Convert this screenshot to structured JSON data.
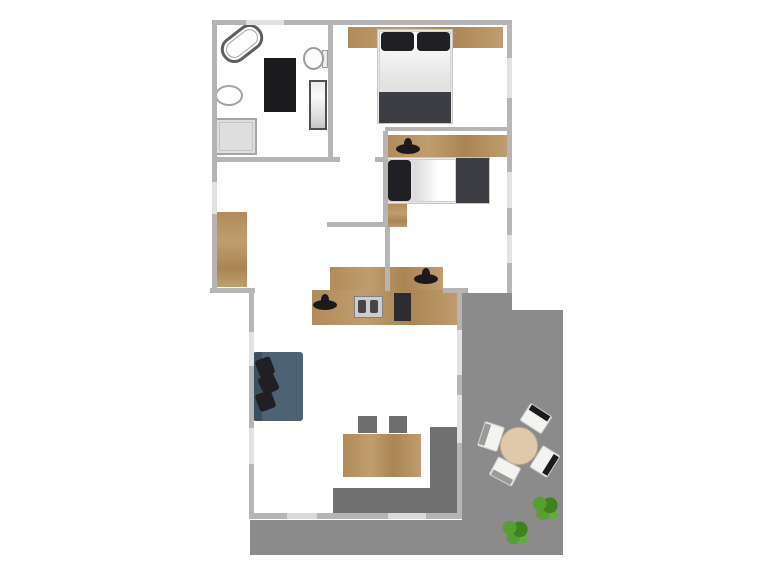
{
  "meta": {
    "canvas_width": 768,
    "canvas_height": 576
  },
  "palette": {
    "wall": "#b7b5b3",
    "window": "#e2e2e2",
    "door": "#d9d9d9",
    "wood-a": "#b18c5a",
    "wood-b": "#c09d6e",
    "wood-c": "#aa8553",
    "terrace": "#8b8b8b",
    "terrace-dark": "#707070",
    "dark-item": "#1b1b1e",
    "pillow": "#1f1f24",
    "blanket": "#3d3d44",
    "sofa": "#4d6374",
    "sofa-dark": "#3c4f5e",
    "chair": "#6e6e6e",
    "table-round": "#dfc9a9",
    "plant-a": "#55a02e",
    "plant-b": "#3f8220",
    "plant-c": "#62ad3a"
  },
  "plan": {
    "regions": [
      {
        "name": "terrace-right-upper",
        "cls": "terrace",
        "x": 462,
        "y": 293,
        "w": 50,
        "h": 262
      },
      {
        "name": "terrace-right-lower",
        "cls": "terrace",
        "x": 512,
        "y": 310,
        "w": 51,
        "h": 245
      },
      {
        "name": "terrace-bottom-band",
        "cls": "terrace",
        "x": 250,
        "y": 520,
        "w": 313,
        "h": 35
      },
      {
        "name": "patio-dark-vertical",
        "cls": "terrace-dark",
        "x": 430,
        "y": 427,
        "w": 28,
        "h": 87
      },
      {
        "name": "patio-dark-horizontal",
        "cls": "terrace-dark",
        "x": 333,
        "y": 488,
        "w": 125,
        "h": 26
      }
    ],
    "furniture": [
      {
        "name": "bathroom-bathtub",
        "cls": "tub",
        "x": 219,
        "y": 30,
        "w": 46,
        "h": 27,
        "rot": -38
      },
      {
        "name": "bathroom-toilet-tank",
        "cls": "tank",
        "x": 322,
        "y": 50,
        "w": 6,
        "h": 18
      },
      {
        "name": "bathroom-toilet-bowl",
        "cls": "toilet",
        "x": 303,
        "y": 47,
        "w": 21,
        "h": 23
      },
      {
        "name": "bathroom-rug",
        "cls": "rug",
        "x": 264,
        "y": 58,
        "w": 32,
        "h": 54
      },
      {
        "name": "bathroom-sink",
        "cls": "sink",
        "x": 215,
        "y": 85,
        "w": 28,
        "h": 21
      },
      {
        "name": "bathroom-cabinet",
        "cls": "cabinet",
        "x": 309,
        "y": 80,
        "w": 18,
        "h": 50
      },
      {
        "name": "bathroom-shower-tray",
        "cls": "shower",
        "x": 215,
        "y": 118,
        "w": 42,
        "h": 37
      },
      {
        "name": "bedroom1-wardrobe-panel",
        "cls": "wood",
        "x": 348,
        "y": 27,
        "w": 155,
        "h": 21
      },
      {
        "name": "bedroom1-bed-frame",
        "cls": "bedframe",
        "x": 377,
        "y": 29,
        "w": 76,
        "h": 95
      },
      {
        "name": "bedroom1-mattress",
        "cls": "mattress",
        "x": 379,
        "y": 31,
        "w": 72,
        "h": 92
      },
      {
        "name": "bedroom1-pillow-left",
        "cls": "pillow",
        "x": 381,
        "y": 32,
        "w": 33,
        "h": 19
      },
      {
        "name": "bedroom1-pillow-right",
        "cls": "pillow",
        "x": 417,
        "y": 32,
        "w": 33,
        "h": 19
      },
      {
        "name": "bedroom1-blanket",
        "cls": "blanket",
        "x": 379,
        "y": 92,
        "w": 72,
        "h": 31
      },
      {
        "name": "bedroom2-desk",
        "cls": "wood",
        "x": 387,
        "y": 135,
        "w": 120,
        "h": 22
      },
      {
        "name": "bedroom2-desk-lamp",
        "cls": "blob",
        "x": 396,
        "y": 144,
        "w": 24,
        "h": 10
      },
      {
        "name": "bedroom2-bed-frame",
        "cls": "bedframe",
        "x": 386,
        "y": 157,
        "w": 104,
        "h": 47
      },
      {
        "name": "bedroom2-mattress",
        "cls": "mattress-h",
        "x": 388,
        "y": 159,
        "w": 68,
        "h": 43
      },
      {
        "name": "bedroom2-pillow",
        "cls": "pillow",
        "x": 388,
        "y": 160,
        "w": 23,
        "h": 41
      },
      {
        "name": "bedroom2-blanket",
        "cls": "blanket",
        "x": 456,
        "y": 158,
        "w": 33,
        "h": 45
      },
      {
        "name": "bedroom2-nightstand",
        "cls": "woodv",
        "x": 386,
        "y": 204,
        "w": 21,
        "h": 23
      },
      {
        "name": "hallway-wardrobe",
        "cls": "woodv",
        "x": 217,
        "y": 212,
        "w": 30,
        "h": 75
      },
      {
        "name": "kitchen-counter-upper",
        "cls": "wood",
        "x": 330,
        "y": 267,
        "w": 113,
        "h": 23
      },
      {
        "name": "kitchen-faucet-upper",
        "cls": "blob",
        "x": 414,
        "y": 274,
        "w": 24,
        "h": 10
      },
      {
        "name": "kitchen-counter-lower",
        "cls": "wood",
        "x": 312,
        "y": 290,
        "w": 148,
        "h": 35
      },
      {
        "name": "kitchen-faucet-lower",
        "cls": "blob",
        "x": 313,
        "y": 300,
        "w": 24,
        "h": 10
      },
      {
        "name": "kitchen-stove",
        "cls": "stove",
        "x": 354,
        "y": 296,
        "w": 29,
        "h": 22
      },
      {
        "name": "kitchen-cutting-board",
        "cls": "board",
        "x": 394,
        "y": 293,
        "w": 17,
        "h": 28
      },
      {
        "name": "living-sofa",
        "cls": "sofa",
        "x": 253,
        "y": 352,
        "w": 50,
        "h": 69
      },
      {
        "name": "living-sofa-backrest",
        "cls": "sofa-back",
        "x": 253,
        "y": 352,
        "w": 9,
        "h": 69
      },
      {
        "name": "living-sofa-pillow-1",
        "cls": "sofa-pillow",
        "x": 257,
        "y": 358,
        "w": 16,
        "h": 18,
        "rot": -20
      },
      {
        "name": "living-sofa-pillow-2",
        "cls": "sofa-pillow",
        "x": 260,
        "y": 375,
        "w": 17,
        "h": 18,
        "rot": -25
      },
      {
        "name": "living-sofa-pillow-3",
        "cls": "sofa-pillow",
        "x": 257,
        "y": 392,
        "w": 17,
        "h": 18,
        "rot": -20
      },
      {
        "name": "dining-chair-1",
        "cls": "chair",
        "x": 358,
        "y": 416,
        "w": 19,
        "h": 17
      },
      {
        "name": "dining-chair-2",
        "cls": "chair",
        "x": 389,
        "y": 416,
        "w": 18,
        "h": 17
      },
      {
        "name": "dining-table",
        "cls": "wood",
        "x": 343,
        "y": 434,
        "w": 78,
        "h": 43
      },
      {
        "name": "terrace-chair-1",
        "cls": "t-chair",
        "x": 523,
        "y": 408,
        "w": 26,
        "h": 21,
        "rot": 33
      },
      {
        "name": "terrace-chair-2",
        "cls": "t-chair light",
        "x": 478,
        "y": 426,
        "w": 26,
        "h": 21,
        "rot": -72
      },
      {
        "name": "terrace-chair-3",
        "cls": "t-chair",
        "x": 532,
        "y": 451,
        "w": 26,
        "h": 21,
        "rot": 122
      },
      {
        "name": "terrace-chair-4",
        "cls": "t-chair light",
        "x": 492,
        "y": 461,
        "w": 26,
        "h": 21,
        "rot": -152
      },
      {
        "name": "terrace-round-table",
        "cls": "round-table",
        "x": 500,
        "y": 427,
        "w": 38,
        "h": 38
      },
      {
        "name": "terrace-plant-1",
        "cls": "plant",
        "x": 530,
        "y": 495,
        "w": 30,
        "h": 27
      },
      {
        "name": "terrace-plant-2",
        "cls": "plant",
        "x": 500,
        "y": 519,
        "w": 30,
        "h": 27
      }
    ],
    "walls": [
      {
        "name": "wall-outer-top",
        "cls": "wall",
        "x": 212,
        "y": 20,
        "w": 300,
        "h": 5
      },
      {
        "name": "wall-outer-left",
        "cls": "wall",
        "x": 212,
        "y": 20,
        "w": 5,
        "h": 273
      },
      {
        "name": "wall-outer-right",
        "cls": "wall",
        "x": 507,
        "y": 20,
        "w": 5,
        "h": 273
      },
      {
        "name": "wall-bathroom-divider",
        "cls": "wall",
        "x": 328,
        "y": 25,
        "w": 5,
        "h": 135
      },
      {
        "name": "wall-hall-top-left",
        "cls": "wall",
        "x": 212,
        "y": 157,
        "w": 128,
        "h": 5
      },
      {
        "name": "wall-hall-top-right",
        "cls": "wall",
        "x": 375,
        "y": 157,
        "w": 12,
        "h": 5
      },
      {
        "name": "wall-bedrooms-divider",
        "cls": "wall",
        "x": 385,
        "y": 127,
        "w": 122,
        "h": 4
      },
      {
        "name": "wall-bedroom2-left",
        "cls": "wall",
        "x": 383,
        "y": 131,
        "w": 5,
        "h": 95
      },
      {
        "name": "wall-bedroom2-bottom",
        "cls": "wall",
        "x": 327,
        "y": 222,
        "w": 60,
        "h": 5
      },
      {
        "name": "wall-hall-right",
        "cls": "wall",
        "x": 385,
        "y": 227,
        "w": 5,
        "h": 64
      },
      {
        "name": "wall-hall-bottom",
        "cls": "wall",
        "x": 210,
        "y": 288,
        "w": 45,
        "h": 5
      },
      {
        "name": "wall-kitchen-right",
        "cls": "wall",
        "x": 443,
        "y": 288,
        "w": 25,
        "h": 5
      },
      {
        "name": "wall-living-left",
        "cls": "wall",
        "x": 249,
        "y": 288,
        "w": 5,
        "h": 231
      },
      {
        "name": "wall-living-right",
        "cls": "wall",
        "x": 457,
        "y": 293,
        "w": 5,
        "h": 226
      },
      {
        "name": "wall-living-bottom",
        "cls": "wall",
        "x": 249,
        "y": 513,
        "w": 213,
        "h": 6
      }
    ],
    "openings": [
      {
        "name": "window-top",
        "cls": "win",
        "x": 246,
        "y": 20,
        "w": 38,
        "h": 5
      },
      {
        "name": "window-right-1",
        "cls": "win",
        "x": 507,
        "y": 58,
        "w": 5,
        "h": 40
      },
      {
        "name": "window-right-2",
        "cls": "win",
        "x": 507,
        "y": 172,
        "w": 5,
        "h": 36
      },
      {
        "name": "window-right-3",
        "cls": "win",
        "x": 507,
        "y": 235,
        "w": 5,
        "h": 28
      },
      {
        "name": "window-left-1",
        "cls": "win",
        "x": 212,
        "y": 182,
        "w": 5,
        "h": 32
      },
      {
        "name": "window-living-left-1",
        "cls": "win",
        "x": 249,
        "y": 332,
        "w": 5,
        "h": 34
      },
      {
        "name": "window-living-left-2",
        "cls": "win",
        "x": 249,
        "y": 428,
        "w": 5,
        "h": 36
      },
      {
        "name": "window-living-right-1",
        "cls": "win",
        "x": 457,
        "y": 330,
        "w": 5,
        "h": 45
      },
      {
        "name": "window-living-right-2",
        "cls": "win",
        "x": 457,
        "y": 395,
        "w": 5,
        "h": 48
      },
      {
        "name": "door-terrace-1",
        "cls": "door",
        "x": 287,
        "y": 513,
        "w": 30,
        "h": 6
      },
      {
        "name": "door-terrace-2",
        "cls": "door",
        "x": 388,
        "y": 513,
        "w": 38,
        "h": 6
      }
    ]
  }
}
